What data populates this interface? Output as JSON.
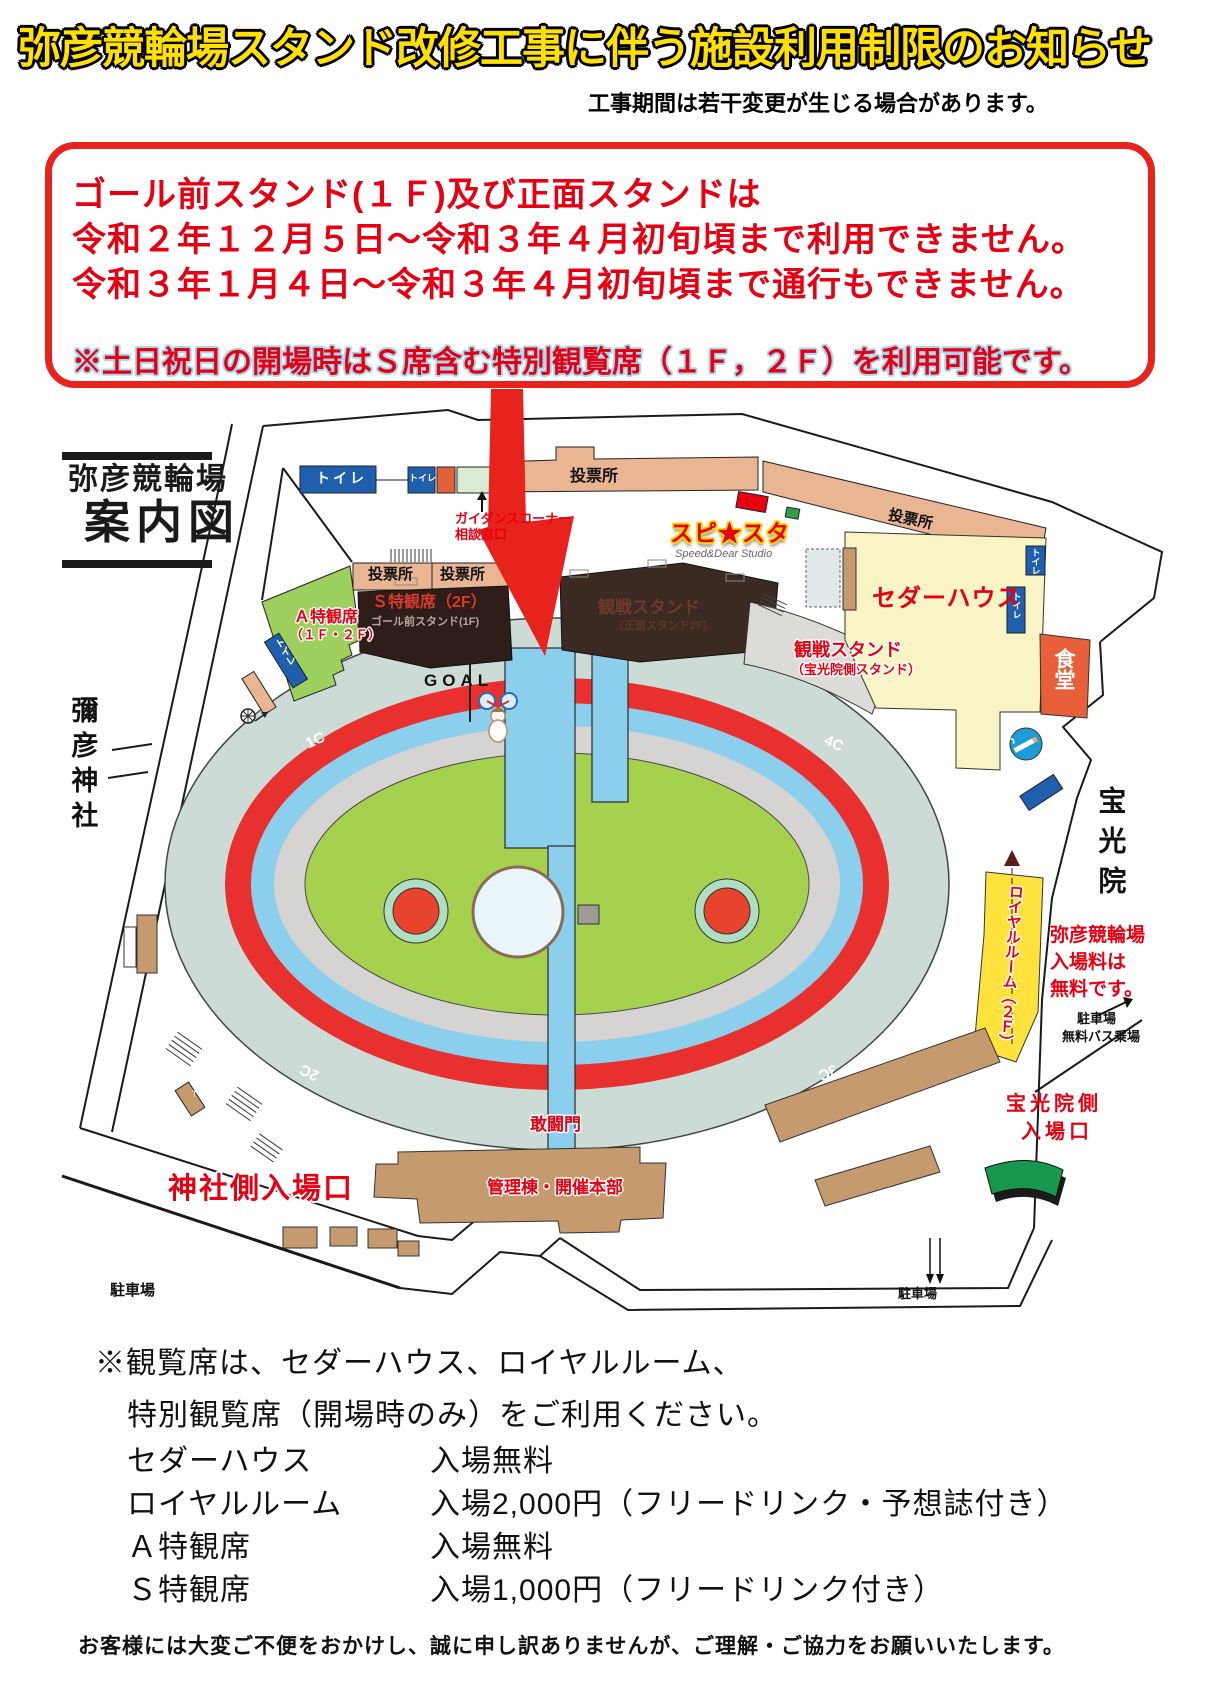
{
  "header": {
    "title": "弥彦競輪場スタンド改修工事に伴う施設利用制限のお知らせ",
    "subtitle": "工事期間は若干変更が生じる場合があります。"
  },
  "notice_box": {
    "line1": "ゴール前スタンド(１Ｆ)及び正面スタンドは",
    "line2": "令和２年１２月５日～令和３年４月初旬頃まで利用できません。",
    "line3": "令和３年１月４日～令和３年４月初旬頃まで通行もできません。",
    "note": "※土日祝日の開場時はＳ席含む特別観覧席（１Ｆ，２Ｆ）を利用可能です。"
  },
  "map": {
    "title_line1": "弥彦競輪場",
    "title_line2": "案内図",
    "labels": {
      "toilet": "トイレ",
      "voting_office": "投票所",
      "guidance_line1": "ガイダンスコーナー",
      "guidance_line2": "相談窓口",
      "studio_logo": "スピ★スタ",
      "studio_sub": "Speed&Dear Studio",
      "cedar_house": "セダーハウス",
      "dining_hall": "食堂",
      "s_seat": "Ｓ特観席（2F）",
      "s_seat_sub": "ゴール前スタンド(1F)",
      "main_stand": "観戦スタンド",
      "main_stand_sub": "（正面スタンド2F）",
      "hokoin_stand": "観戦スタンド",
      "hokoin_stand_sub": "（宝光院側スタンド）",
      "a_seat": "Ａ特観席",
      "a_seat_sub": "（１Ｆ・２Ｆ）",
      "goal": "GOAL",
      "corner_1": "1C",
      "corner_2": "2C",
      "corner_3": "3C",
      "corner_4": "4C",
      "yahiko_shrine": "彌彦神社",
      "hokoin_temple": "宝光院",
      "royal_room": "ロイヤルルーム（２Ｆ）",
      "admission_line1": "弥彦競輪場",
      "admission_line2": "入場料は",
      "admission_line3": "無料です。",
      "parking": "駐車場",
      "free_bus": "無料バス乗場",
      "kanto_gate": "敢闘門",
      "shrine_entrance": "神社側入場口",
      "admin_building": "管理棟・開催本部",
      "hokoin_entrance_line1": "宝光院側",
      "hokoin_entrance_line2": "入場口",
      "entrance_gate": "入場門"
    }
  },
  "info": {
    "heading_line1": "※観覧席は、セダーハウス、ロイヤルルーム、",
    "heading_line2": "特別観覧席（開場時のみ）をご利用ください。",
    "rows": [
      {
        "name": "セダーハウス",
        "price": "入場無料"
      },
      {
        "name": "ロイヤルルーム",
        "price": "入場2,000円（フリードリンク・予想誌付き）"
      },
      {
        "name": "Ａ特観席",
        "price": "入場無料"
      },
      {
        "name": "Ｓ特観席",
        "price": "入場1,000円（フリードリンク付き）"
      }
    ],
    "apology": "お客様には大変ご不便をおかけし、誠に申し訳ありませんが、ご理解・ご協力をお願いいたします。"
  },
  "colors": {
    "title_yellow": "#ffe000",
    "notice_red": "#e60012",
    "track_red": "#e8312e",
    "track_blue": "#8ccfec",
    "infield_green": "#a6d14e",
    "building_salmon": "#e9b592",
    "building_brown": "#c59a6e",
    "royal_yellow": "#ffe33c",
    "cedar_yellow": "#f9f4c5",
    "toilet_blue": "#1f5fae"
  }
}
